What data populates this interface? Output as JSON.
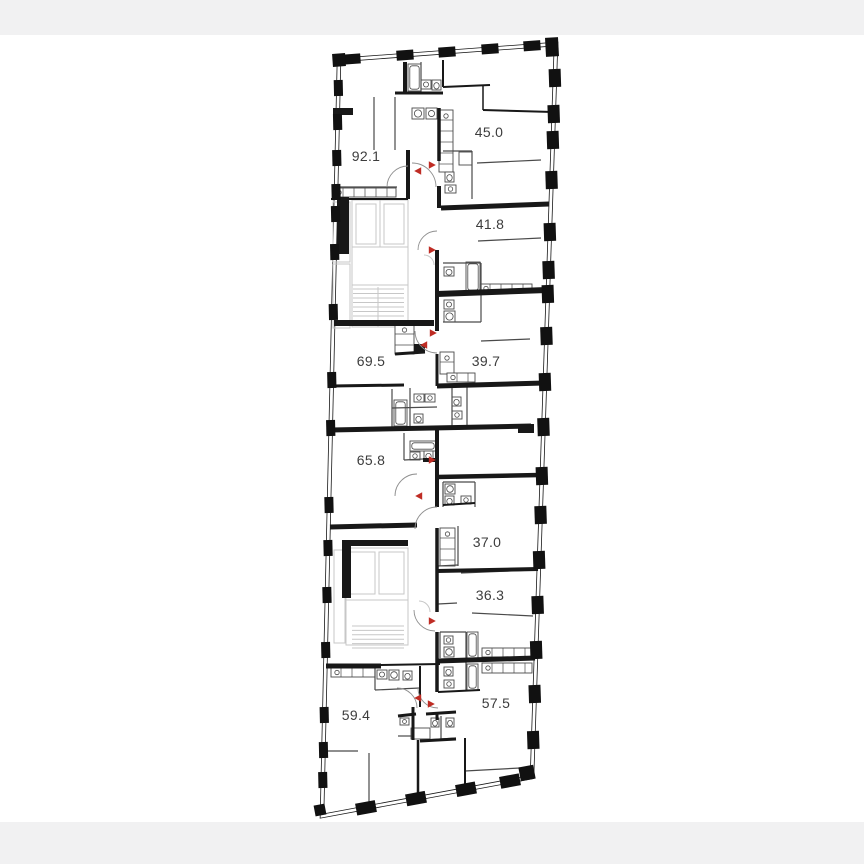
{
  "page": {
    "background_color": "#ffffff",
    "letterbox_color": "#f1f1f2"
  },
  "floor_plan": {
    "type": "residential-floor-plan",
    "wall_color": "#181818",
    "thin_wall_color": "#4a4a4a",
    "core_line_color": "#c7c7c7",
    "door_arc_color": "#8f8f8f",
    "entry_arrow_color": "#bf2c24",
    "label_color": "#3d3d3d",
    "units": [
      {
        "id": "unit-1",
        "area_label": "92.1"
      },
      {
        "id": "unit-2",
        "area_label": "45.0"
      },
      {
        "id": "unit-3",
        "area_label": "41.8"
      },
      {
        "id": "unit-4",
        "area_label": "69.5"
      },
      {
        "id": "unit-5",
        "area_label": "39.7"
      },
      {
        "id": "unit-6",
        "area_label": "65.8"
      },
      {
        "id": "unit-7",
        "area_label": "37.0"
      },
      {
        "id": "unit-8",
        "area_label": "36.3"
      },
      {
        "id": "unit-9",
        "area_label": "59.4"
      },
      {
        "id": "unit-10",
        "area_label": "57.5"
      }
    ]
  }
}
